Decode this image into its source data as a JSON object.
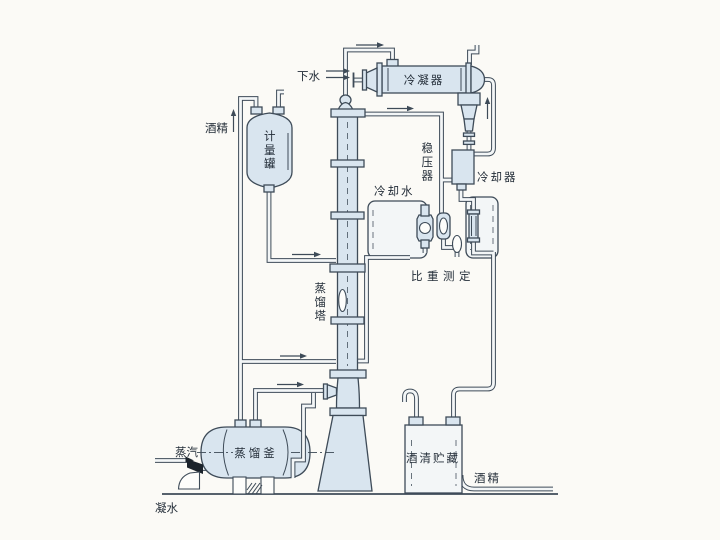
{
  "diagram": {
    "type": "process-flow-diagram",
    "subject": "alcohol distillation system"
  },
  "colors": {
    "background": "#fbfaf6",
    "line": "#3e4b58",
    "vessel_fill": "#d9e5ef",
    "pipe_fill": "#f3f6f7",
    "text": "#232d38",
    "valve": "#1b232b"
  },
  "labels": {
    "drain_water": "下水",
    "condenser": "冷凝器",
    "alcohol_feed": "酒精",
    "metering_tank": "计量罐",
    "stabilizer": "稳压器",
    "cooling_water": "冷却水",
    "cooler": "冷却器",
    "gravity_measurement": "比重测定",
    "tower": "蒸馏塔",
    "kettle": "蒸馏釜",
    "steam": "蒸汽",
    "storage": "酒清贮藏",
    "alcohol_product": "酒精",
    "condensate": "凝水"
  }
}
